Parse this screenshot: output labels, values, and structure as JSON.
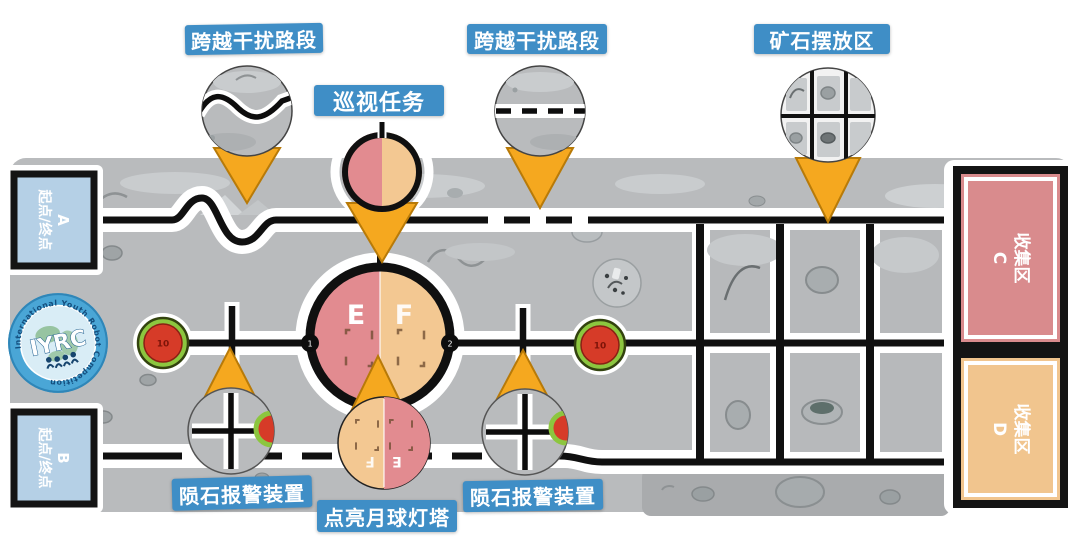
{
  "labels": {
    "cross1": "跨越干扰路段",
    "patrol": "巡视任务",
    "cross2": "跨越干扰路段",
    "ore": "矿石摆放区",
    "alarm_left": "陨石报警装置",
    "lighthouse": "点亮月球灯塔",
    "alarm_right": "陨石报警装置"
  },
  "zones": {
    "a": {
      "letter": "A",
      "name": "起点/终点"
    },
    "b": {
      "letter": "B",
      "name": "起点/终点"
    },
    "c": {
      "letter": "C",
      "name": "收集区"
    },
    "d": {
      "letter": "D",
      "name": "收集区"
    }
  },
  "ring": {
    "left": "E",
    "right": "F"
  },
  "lighthouse_view": {
    "left": "E",
    "right": "F"
  },
  "junctions": {
    "one": "1",
    "two": "2"
  },
  "alarms": {
    "left": "10",
    "right": "10"
  },
  "logo": {
    "arc": "International Youth Robot Competition",
    "name": "IYRC"
  },
  "colors": {
    "label_bg": "#3f8ec6",
    "field_gray": "#b9bbbd",
    "path_black": "#111111",
    "zone_ab_blue": "#b5d0e6",
    "zone_c_pink": "#d98b8d",
    "zone_d_tan": "#f1c58e",
    "ring_left_pink": "#e28b90",
    "ring_right_tan": "#f3c892",
    "alarm_red": "#d63b28",
    "alarm_green": "#8cc63f",
    "pointer_orange": "#f5a81f"
  }
}
